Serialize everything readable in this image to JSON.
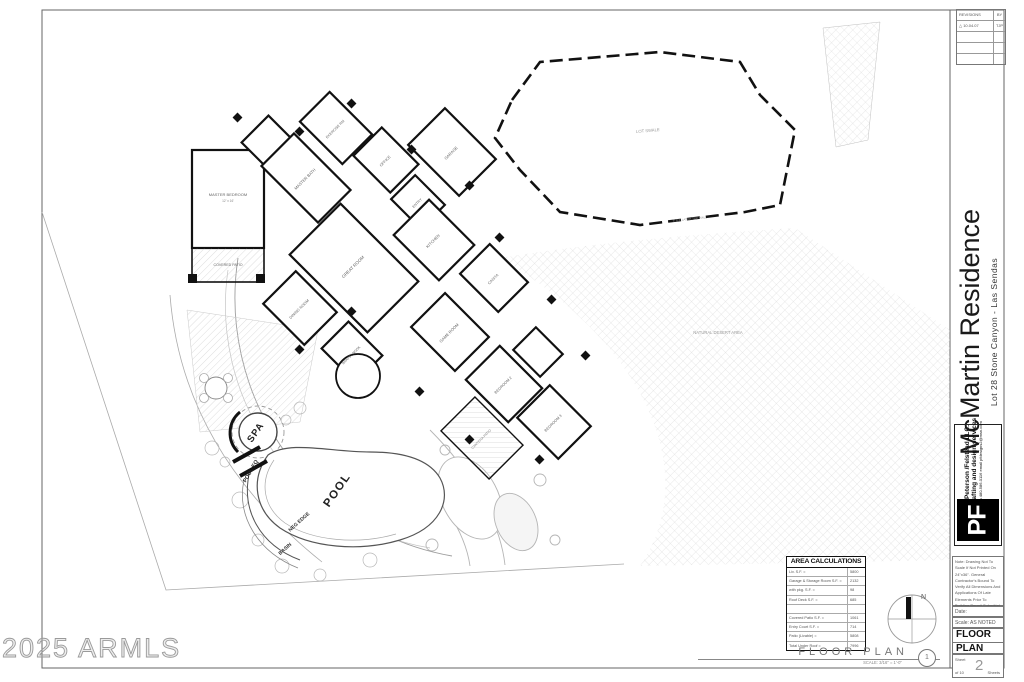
{
  "sheet": {
    "watermark": "2025 ARMLS",
    "drawing_title": "FLOOR  PLAN",
    "drawing_number": "1",
    "drawing_scale": "SCALE: 3/16\" = 1'-0\"",
    "north_label": "N"
  },
  "title_block": {
    "project_title": "McMartin Residence",
    "project_subtitle": "Lot 28   Stone Canyon - Las Sendas",
    "revisions": {
      "header": "REVISIONS",
      "by_header": "BY",
      "rows": [
        {
          "entry": "△ 10.04.07",
          "by": "TJP"
        }
      ]
    },
    "firm": {
      "logo": "PF",
      "name": "Peterson /Felstead LLC.",
      "tagline": "drafting and design services",
      "contact": "ph 480-586-0116 email pfdesigns2@msn.com"
    },
    "note": "Note: Drawing Not To Scale If Not Printed On 24\"x36\". General Contractor's Bound To Verify All Dimensions And Applications Of Late Elements Prior To Building Permit Submittal",
    "date_label": "Date:",
    "scale_label": "Scale:",
    "scale_value": "AS NOTED",
    "sheet_name_line1": "FLOOR",
    "sheet_name_line2": "PLAN",
    "sheet_label": "Sheet",
    "sheet_number": "2",
    "sheet_of": "of 10",
    "sheets_label": "Sheets"
  },
  "area_calculations": {
    "title": "AREA CALCULATIONS",
    "rows": [
      {
        "label": "Liv. S.F. =",
        "value": "5800"
      },
      {
        "label": "Garage & Storage Room S.F. =",
        "value": "2132"
      },
      {
        "label": "with pkg. S.F. =",
        "value": "98"
      },
      {
        "label": "Roof Deck S.F. =",
        "value": "685"
      },
      {
        "label": "",
        "value": ""
      },
      {
        "label": "Covered Patio S.F. =",
        "value": "1061"
      },
      {
        "label": "Entry Court S.F. =",
        "value": "714"
      },
      {
        "label": "Patio (Livable) =",
        "value": "5808"
      },
      {
        "label": "Total Under Roof =",
        "value": "7996"
      }
    ]
  },
  "plan_labels": [
    {
      "t": "MASTER BEDROOM",
      "x": 228,
      "y": 196,
      "r": 0,
      "s": 4,
      "w": 400,
      "c": "#666"
    },
    {
      "t": "12' x 16'",
      "x": 228,
      "y": 202,
      "r": 0,
      "s": 3.2,
      "w": 400,
      "c": "#888"
    },
    {
      "t": "COVERED PATIO",
      "x": 228,
      "y": 266,
      "r": 0,
      "s": 3.6,
      "w": 400,
      "c": "#666"
    },
    {
      "t": "MASTER BATH",
      "x": 306,
      "y": 180,
      "r": -45,
      "s": 4,
      "w": 400,
      "c": "#666"
    },
    {
      "t": "EXERCISE RM",
      "x": 336,
      "y": 130,
      "r": -45,
      "s": 3.6,
      "w": 400,
      "c": "#666"
    },
    {
      "t": "OFFICE",
      "x": 386,
      "y": 162,
      "r": -45,
      "s": 3.8,
      "w": 400,
      "c": "#666"
    },
    {
      "t": "GARAGE",
      "x": 452,
      "y": 154,
      "r": -45,
      "s": 4,
      "w": 400,
      "c": "#666"
    },
    {
      "t": "ENTRY",
      "x": 418,
      "y": 204,
      "r": -45,
      "s": 3.6,
      "w": 400,
      "c": "#666"
    },
    {
      "t": "GREAT ROOM",
      "x": 354,
      "y": 268,
      "r": -45,
      "s": 4.4,
      "w": 400,
      "c": "#666"
    },
    {
      "t": "KITCHEN",
      "x": 434,
      "y": 242,
      "r": -45,
      "s": 4,
      "w": 400,
      "c": "#666"
    },
    {
      "t": "DINING ROOM",
      "x": 300,
      "y": 310,
      "r": -45,
      "s": 3.8,
      "w": 400,
      "c": "#666"
    },
    {
      "t": "BRKFST NOOK",
      "x": 352,
      "y": 356,
      "r": -45,
      "s": 3.4,
      "w": 400,
      "c": "#666"
    },
    {
      "t": "GAME ROOM",
      "x": 450,
      "y": 334,
      "r": -45,
      "s": 4,
      "w": 400,
      "c": "#666"
    },
    {
      "t": "CASITA",
      "x": 494,
      "y": 280,
      "r": -45,
      "s": 3.8,
      "w": 400,
      "c": "#666"
    },
    {
      "t": "BEDROOM 2",
      "x": 504,
      "y": 386,
      "r": -45,
      "s": 3.8,
      "w": 400,
      "c": "#666"
    },
    {
      "t": "BEDROOM 3",
      "x": 554,
      "y": 424,
      "r": -45,
      "s": 3.8,
      "w": 400,
      "c": "#666"
    },
    {
      "t": "CANTERA PATIO",
      "x": 482,
      "y": 440,
      "r": -45,
      "s": 3.4,
      "w": 400,
      "c": "#888"
    },
    {
      "t": "LOT SWALE",
      "x": 648,
      "y": 132,
      "r": -5,
      "s": 4.2,
      "w": 400,
      "c": "#999"
    },
    {
      "t": "NATURAL DESERT AREA",
      "x": 718,
      "y": 334,
      "r": 0,
      "s": 4.2,
      "w": 400,
      "c": "#999"
    },
    {
      "t": "6' X 6' LATCH TOP WALL",
      "x": 690,
      "y": 220,
      "r": -6,
      "s": 3,
      "w": 400,
      "c": "#999"
    },
    {
      "t": "SPA",
      "x": 258,
      "y": 434,
      "r": -55,
      "s": 9.5,
      "w": 700,
      "c": "#222",
      "ls": 1
    },
    {
      "t": "POOL EQ",
      "x": 252,
      "y": 472,
      "r": -60,
      "s": 5.5,
      "w": 700,
      "c": "#222"
    },
    {
      "t": "POOL",
      "x": 340,
      "y": 492,
      "r": -55,
      "s": 11.5,
      "w": 700,
      "c": "#222",
      "ls": 1.5
    },
    {
      "t": "NEG EDGE",
      "x": 300,
      "y": 523,
      "r": -42,
      "s": 5,
      "w": 600,
      "c": "#333"
    },
    {
      "t": "BASIN",
      "x": 286,
      "y": 550,
      "r": -42,
      "s": 5,
      "w": 600,
      "c": "#333"
    }
  ]
}
